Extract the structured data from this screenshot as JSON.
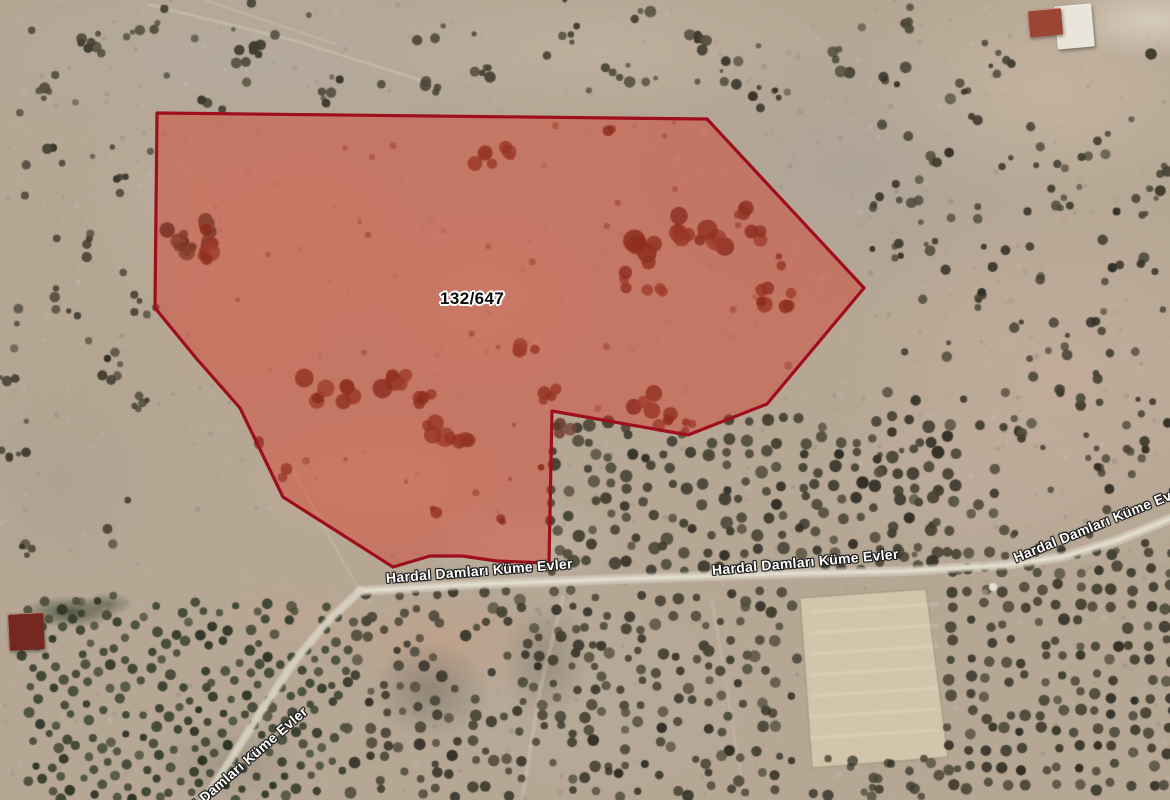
{
  "map": {
    "kind": "satellite-imagery-with-parcel-overlay",
    "width": 1170,
    "height": 800
  },
  "colors": {
    "terrain_base": "#b6a795",
    "parcel_fill": "#dd2f1e",
    "parcel_fill_opacity": 0.4,
    "parcel_stroke": "#9e0e1c",
    "parcel_stroke_width": 3.2,
    "road_core": "rgba(214,207,192,0.92)",
    "road_halo": "rgba(226,219,204,0.45)",
    "road_label_text": "#ffffff",
    "road_label_outline": "#1c1c1c",
    "parcel_label_text": "#0a0a0a",
    "parcel_label_outline": "#ffffff"
  },
  "parcel": {
    "id_label": "132/647",
    "label_pos": {
      "x": 440,
      "y": 289
    },
    "points": [
      [
        157,
        113
      ],
      [
        707,
        119
      ],
      [
        864,
        288
      ],
      [
        767,
        404
      ],
      [
        688,
        435
      ],
      [
        552,
        411
      ],
      [
        549,
        563
      ],
      [
        497,
        561
      ],
      [
        462,
        556
      ],
      [
        430,
        556
      ],
      [
        393,
        567
      ],
      [
        283,
        497
      ],
      [
        240,
        408
      ],
      [
        196,
        358
      ],
      [
        155,
        308
      ]
    ]
  },
  "roads": {
    "main_road": [
      [
        360,
        591
      ],
      [
        480,
        584
      ],
      [
        620,
        579
      ],
      [
        770,
        574
      ],
      [
        905,
        571
      ],
      [
        1005,
        565
      ],
      [
        1062,
        557
      ],
      [
        1118,
        540
      ],
      [
        1172,
        518
      ]
    ],
    "west_road": [
      [
        360,
        591
      ],
      [
        326,
        623
      ],
      [
        294,
        662
      ],
      [
        260,
        713
      ],
      [
        228,
        764
      ],
      [
        203,
        802
      ]
    ],
    "labels": [
      {
        "text": "Hardal Damları Küme Evler",
        "x": 386,
        "y": 570,
        "rotate": -4.5
      },
      {
        "text": "Hardal Damları Küme Evler",
        "x": 712,
        "y": 562,
        "rotate": -5
      },
      {
        "text": "Hardal Damları Küme Evler",
        "x": 1014,
        "y": 550,
        "rotate": -22
      },
      {
        "text": "Hardal Damları Küme Evler",
        "x": 164,
        "y": 824,
        "rotate": -41
      }
    ]
  },
  "buildings": [
    {
      "name": "farmhouse-northeast-wall",
      "x": 1056,
      "y": 5,
      "w": 37,
      "h": 43,
      "rotate": -5,
      "color": "#e9e5da"
    },
    {
      "name": "farmhouse-northeast-roof",
      "x": 1028,
      "y": 9,
      "w": 34,
      "h": 27,
      "rotate": -5,
      "color": "#9b4634"
    },
    {
      "name": "building-southwest-roof",
      "x": 8,
      "y": 613,
      "w": 36,
      "h": 37,
      "rotate": -3,
      "color": "#74281f"
    }
  ]
}
